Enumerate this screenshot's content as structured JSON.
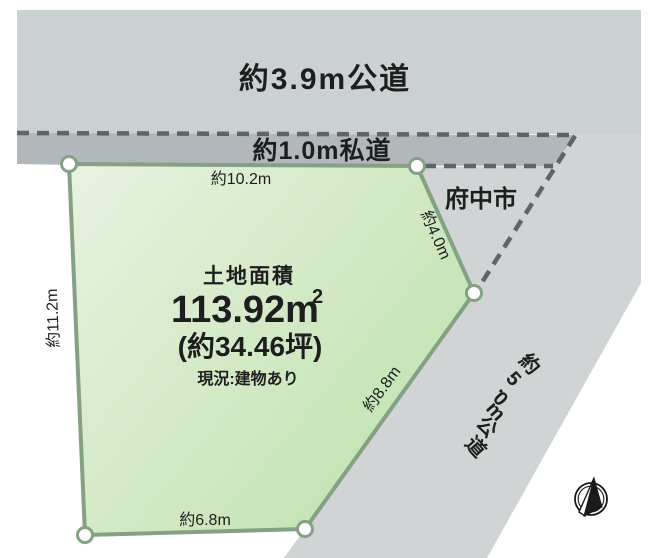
{
  "roads": {
    "top_label": "約3.9m公道",
    "private_label": "約1.0m私道",
    "right_label": "約5.0m公道"
  },
  "city_label": "府中市",
  "plot": {
    "title": "土地面積",
    "area_main": "113.92m",
    "area_sup": "2",
    "area_tsubo": "(約34.46坪)",
    "status": "現況:建物あり",
    "dims": {
      "top": "約10.2m",
      "left": "約11.2m",
      "upper_right": "約4.0m",
      "lower_right": "約8.8m",
      "bottom": "約6.8m"
    }
  },
  "colors": {
    "road_gray": "#cbd1d2",
    "right_road_gray": "#d0d4d5",
    "private_road_gray": "#b1b7ba",
    "plot_green_light": "#e8f2e1",
    "plot_green_dark": "#bfe2ae",
    "plot_border": "#85a184",
    "dash": "#5e6467",
    "text": "#1e1e1e",
    "compass": "#1a1a1a"
  },
  "icons": {
    "compass": "north-compass"
  }
}
